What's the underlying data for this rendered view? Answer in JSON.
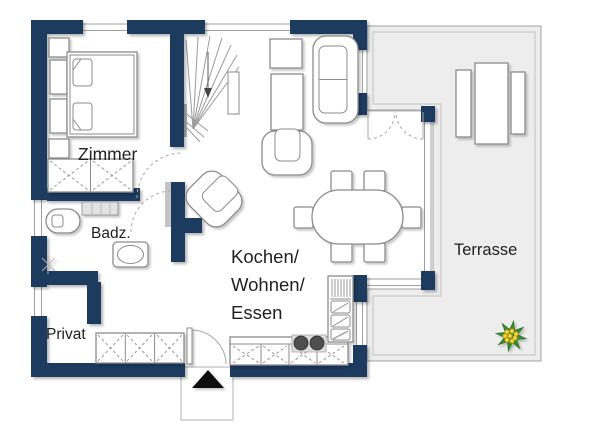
{
  "colors": {
    "wall": "#1c3b5e",
    "terrace_fill": "#ededee",
    "terrace_border": "#a0a0a0",
    "text": "#1f1f1f",
    "cooktop": "#4f4f4f",
    "plant_green": "#3d8f2f",
    "plant_yellow": "#f2d235",
    "entrance_arrow": "#0a0a0a"
  },
  "rooms": {
    "zimmer": {
      "label": "Zimmer"
    },
    "badezimmer": {
      "label": "Badz."
    },
    "privat": {
      "label": "Privat"
    },
    "wohnbereich": {
      "label_lines": [
        "Kochen/",
        "Wohnen/",
        "Essen"
      ]
    },
    "terrasse": {
      "label": "Terrasse"
    }
  }
}
